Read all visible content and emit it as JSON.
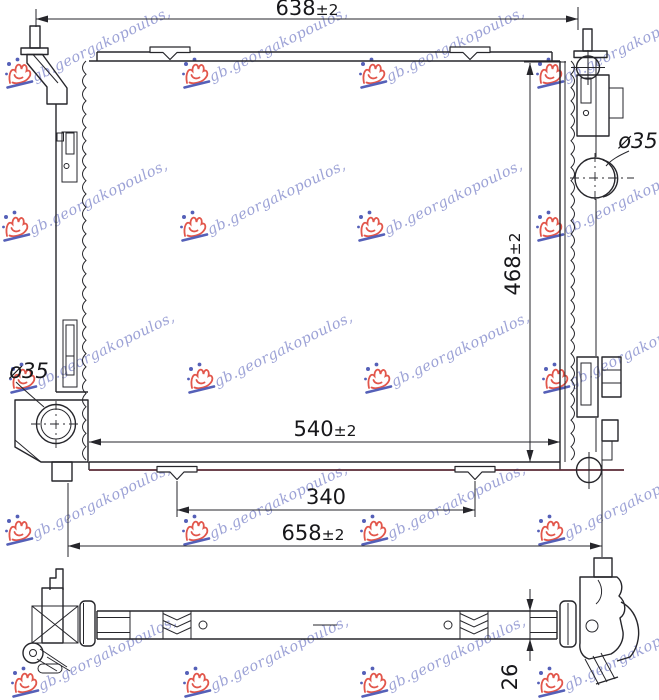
{
  "dimensions": {
    "top_width": {
      "value": "638",
      "tolerance": "±2"
    },
    "height": {
      "value": "468",
      "tolerance": "±2"
    },
    "core_width": {
      "value": "540",
      "tolerance": "±2"
    },
    "clip_spacing": {
      "value": "340",
      "tolerance": ""
    },
    "overall_width": {
      "value": "658",
      "tolerance": "±2"
    },
    "depth": {
      "value": "26",
      "tolerance": ""
    },
    "top_pipe_diameter": "ø35",
    "bottom_pipe_diameter": "ø35"
  },
  "watermark": {
    "text": "gb.georgakopoulos,"
  },
  "colors": {
    "line": "#26262b",
    "accent_line": "#5a2a34",
    "watermark_text": "#9298d2",
    "watermark_logo_red": "#e2564b",
    "watermark_logo_blue": "#5560b8",
    "background": "#ffffff"
  }
}
